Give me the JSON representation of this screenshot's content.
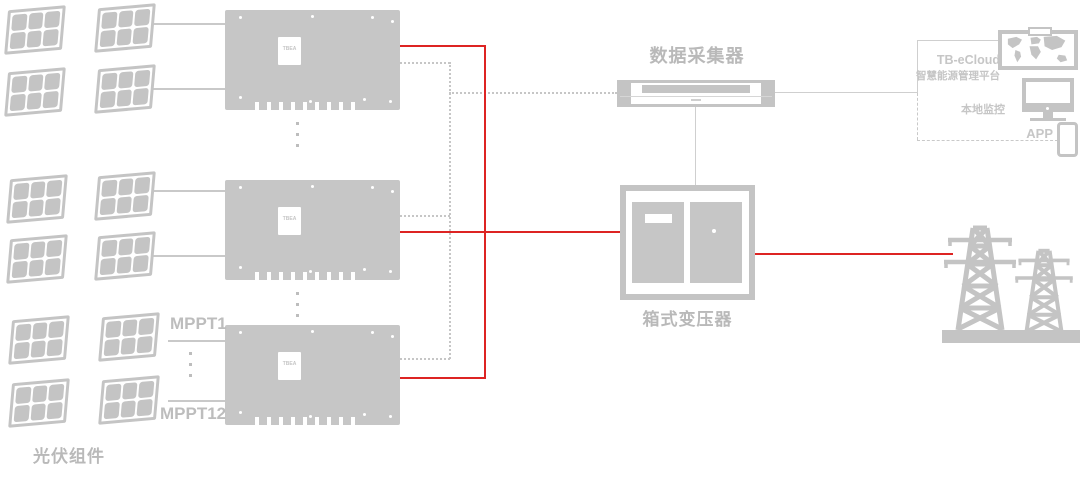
{
  "labels": {
    "pv_modules": "光伏组件",
    "mppt_first": "MPPT1",
    "mppt_last": "MPPT12",
    "data_collector": "数据采集器",
    "transformer": "箱式变压器",
    "inverter_brand": "TBEA"
  },
  "cloud": {
    "platform_name": "TB-eCloud",
    "platform_subtitle": "智慧能源管理平台",
    "local_monitoring": "本地监控",
    "app": "APP"
  },
  "colors": {
    "device_gray": "#c4c4c4",
    "line_gray": "#c9c9c9",
    "power_red": "#dd2423",
    "label_gray": "#b9b9b9"
  },
  "icons": {
    "solar_panel": "pv-module-icon",
    "world_map": "world-map-screen-icon",
    "monitor": "desktop-monitor-icon",
    "phone": "smartphone-icon",
    "towers": "transmission-tower-icon"
  }
}
